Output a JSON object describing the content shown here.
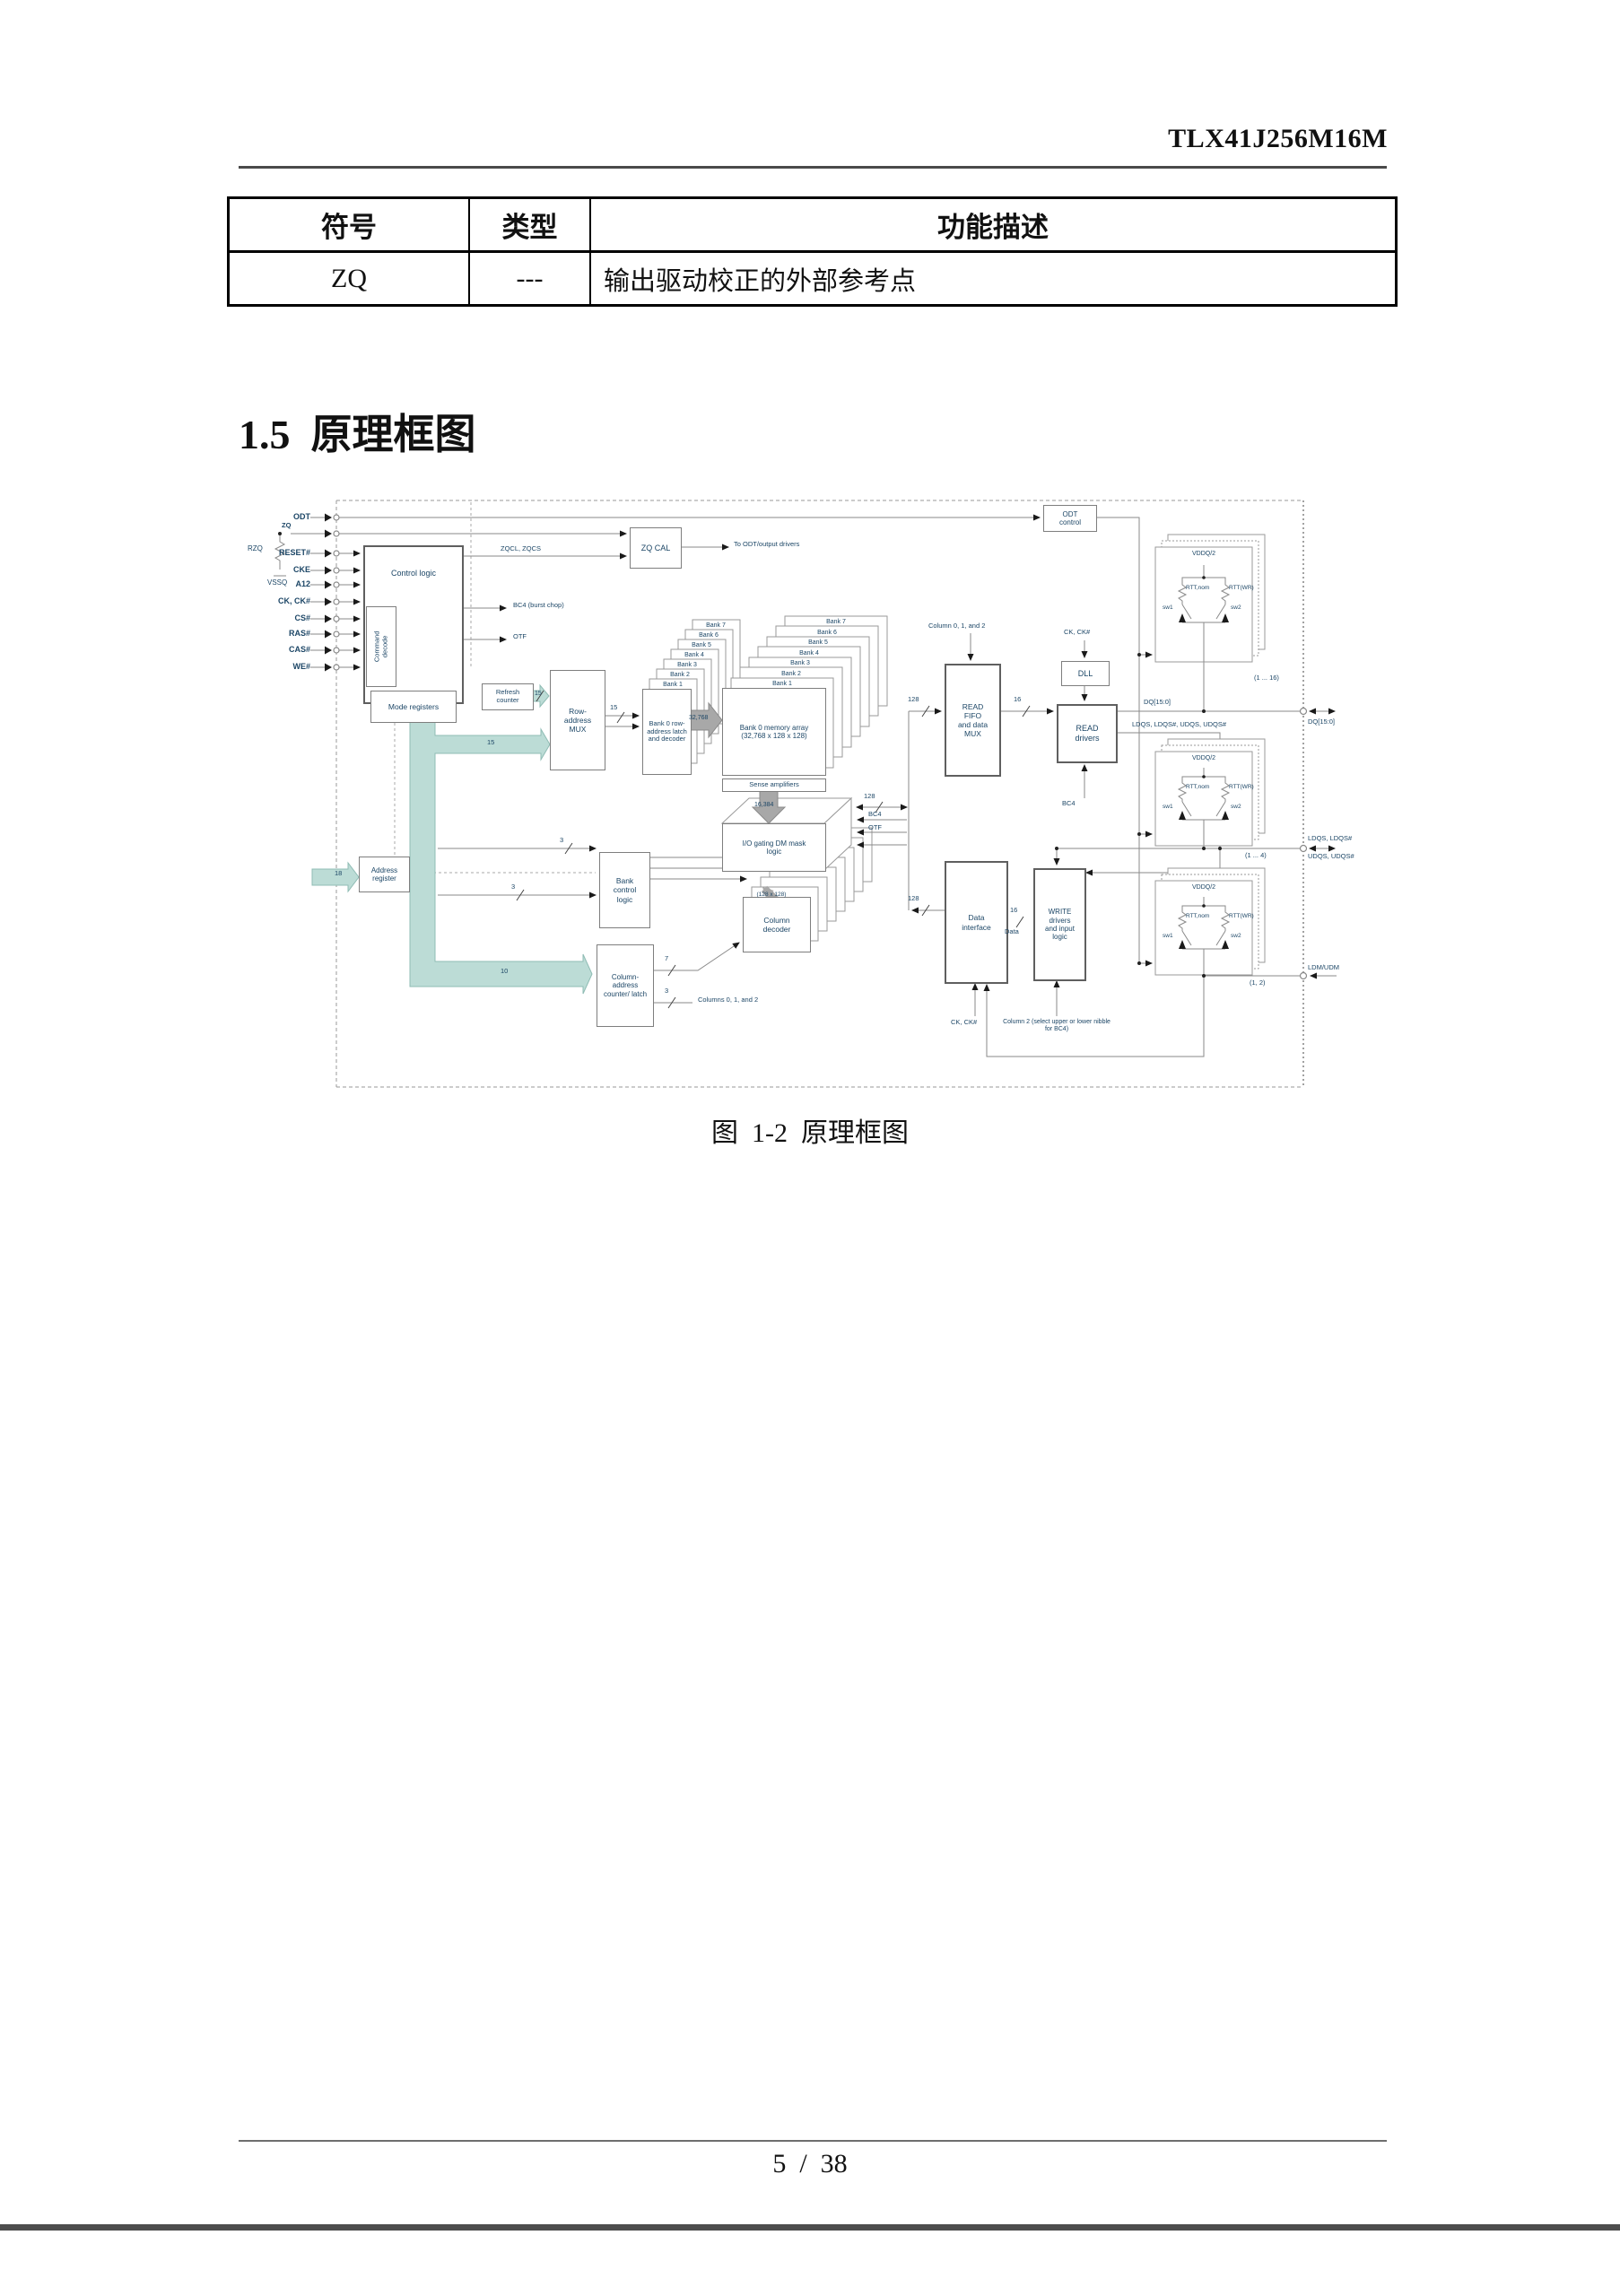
{
  "page": {
    "doc_number": "TLX41J256M16M",
    "section_title": "1.5  原理框图",
    "figure_caption": "图  1-2  原理框图",
    "page_number": "5  /  38"
  },
  "pin_table": {
    "headers": [
      "符号",
      "类型",
      "功能描述"
    ],
    "rows": [
      {
        "symbol": "ZQ",
        "type": "---",
        "description": "输出驱动校正的外部参考点"
      }
    ]
  },
  "diagram": {
    "pins": [
      "ODT",
      "RESET#",
      "CKE",
      "A12",
      "CK, CK#",
      "CS#",
      "RAS#",
      "CAS#",
      "WE#"
    ],
    "zq_pin": "ZQ",
    "rzq_label": "RZQ",
    "vssq_label": "VSSQ",
    "blocks": {
      "control_logic": "Control logic",
      "command_decode": "Command decode",
      "mode_registers": "Mode registers",
      "zq_cal": "ZQ CAL",
      "odt_control": "ODT control",
      "refresh_counter": "Refresh counter",
      "row_mux": "Row- address MUX",
      "address_register": "Address register",
      "bank_latch": "Bank 0 row- address latch and decoder",
      "memory_array": "Bank 0 memory array (32,768 x 128 x 128)",
      "sense_amps": "Sense amplifiers",
      "io_gating": "I/O gating DM mask logic",
      "bank_control": "Bank control logic",
      "col_counter": "Column- address counter/ latch",
      "col_decoder": "Column decoder",
      "read_fifo": "READ FIFO and data MUX",
      "dll": "DLL",
      "read_drivers": "READ drivers",
      "write_drivers": "WRITE drivers and input logic",
      "data_interface": "Data interface"
    },
    "bank_labels": [
      "Bank 7",
      "Bank 6",
      "Bank 5",
      "Bank 4",
      "Bank 3",
      "Bank 2",
      "Bank 1"
    ],
    "labels": {
      "zqcl": "ZQCL, ZQCS",
      "to_odt": "To ODT/output drivers",
      "bc4_chop": "BC4 (burst chop)",
      "otf": "OTF",
      "n15_refresh": "15",
      "n15_bus": "15",
      "n15_mux": "15",
      "n18": "18",
      "n10": "10",
      "n3_a": "3",
      "n3_b": "3",
      "n3_c": "3",
      "n7": "7",
      "n32768": "32,768",
      "n16384": "16,384",
      "n128_io": "128",
      "bc4_io": "BC4",
      "otf_io": "OTF",
      "n128_fifo": "128",
      "n16_fifo": "16",
      "n128_di": "128",
      "n16_data": "16",
      "data_word": "Data",
      "col012_fifo": "Column 0, 1, and 2",
      "cols012": "Columns 0, 1, and 2",
      "col2_note": "Column 2 (select upper or lower nibble for BC4)",
      "ck_dll": "CK, CK#",
      "ck_di": "CK, CK#",
      "dq_line": "DQ[15:0]",
      "dqs_line": "LDQS, LDQS#, UDQS, UDQS#",
      "bc4_rd": "BC4",
      "p128x128": "(128 x 128)"
    },
    "termination": {
      "vddq": "VDDQ/2",
      "rtt_nom": "RTT,nom",
      "rtt_wr": "RTT(WR)",
      "sw1": "sw1",
      "sw2": "sw2",
      "count_dq": "(1 ... 16)",
      "count_dqs": "(1 ... 4)",
      "count_dm": "(1, 2)"
    },
    "external": {
      "dq": "DQ[15:0]",
      "dqs_l": "LDQS, LDQS#",
      "dqs_u": "UDQS, UDQS#",
      "dm": "LDM/UDM"
    }
  }
}
